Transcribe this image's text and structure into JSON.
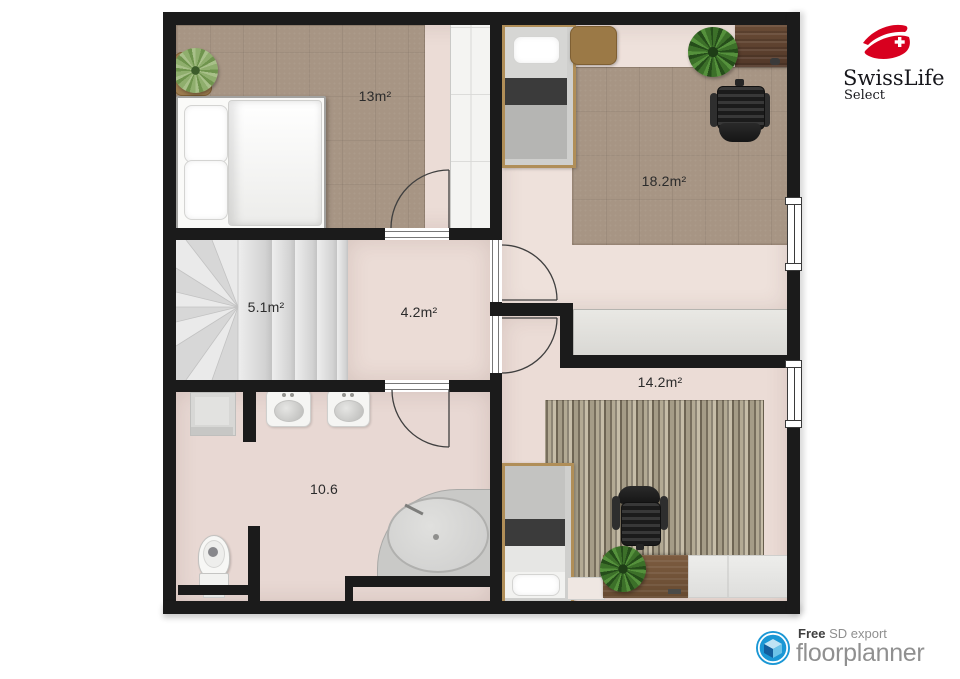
{
  "branding": {
    "swisslife": {
      "name": "SwissLife",
      "subname": "Select"
    },
    "floorplanner": {
      "free_label": "Free",
      "export_label": "SD export",
      "name": "floorplanner"
    }
  },
  "floorplan": {
    "rooms": [
      {
        "id": "bedroom-13",
        "label": "13m²"
      },
      {
        "id": "bedroom-18",
        "label": "18.2m²"
      },
      {
        "id": "staircase",
        "label": "5.1m²"
      },
      {
        "id": "hallway",
        "label": "4.2m²"
      },
      {
        "id": "bedroom-14",
        "label": "14.2m²"
      },
      {
        "id": "bathroom",
        "label": "10.6"
      }
    ],
    "colors": {
      "wall": "#1b1b1b",
      "floor": "#ebdcd6",
      "carpet": "#a79584",
      "stairs": "#e0e0e0",
      "closet": "#e2e1dd",
      "swisslife_red": "#d8001f",
      "floorplanner_blue": "#1a97d5"
    }
  }
}
